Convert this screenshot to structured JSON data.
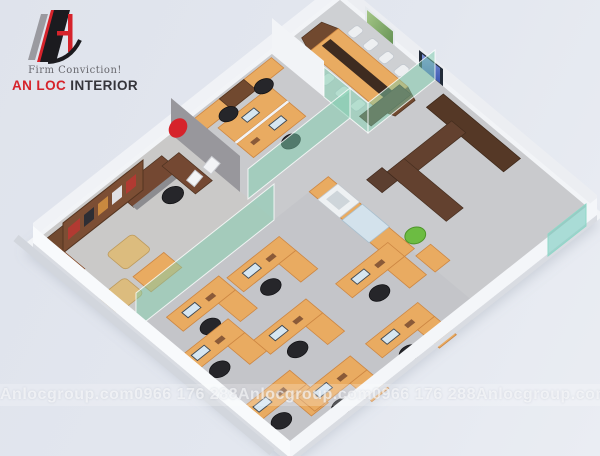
{
  "logo": {
    "tagline": "Firm Conviction!",
    "brand_primary": "AN LOC",
    "brand_secondary": "INTERIOR"
  },
  "watermark": {
    "items": [
      "Anlocgroup.com",
      "0966 176 288",
      "Anlocgroup.com",
      "0966 176 288",
      "Anlocgroup.com"
    ]
  },
  "colors": {
    "brand-red": "#d6232b",
    "wood": "#e9ab61",
    "wood-dark": "#71492f",
    "glass": "#7ecead",
    "wall": "#f2f4f7",
    "floor": "#c9cacd",
    "bg": "#e3e7ef"
  }
}
